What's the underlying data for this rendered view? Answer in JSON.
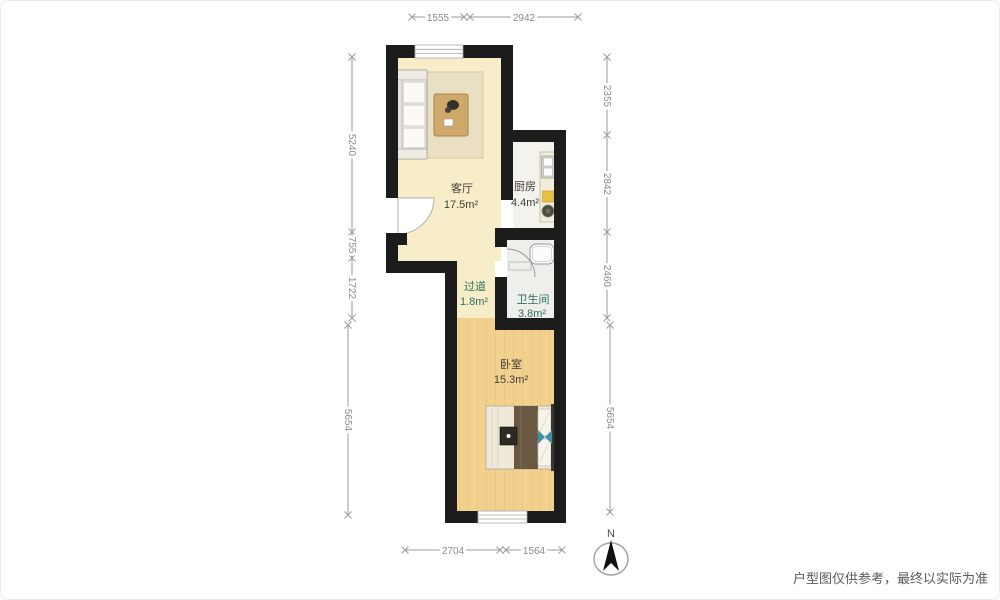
{
  "rooms": {
    "living": {
      "name": "客厅",
      "area": "17.5m²"
    },
    "kitchen": {
      "name": "厨房",
      "area": "4.4m²"
    },
    "hallway": {
      "name": "过道",
      "area": "1.8m²"
    },
    "bathroom": {
      "name": "卫生间",
      "area": "3.8m²"
    },
    "bedroom": {
      "name": "卧室",
      "area": "15.3m²"
    }
  },
  "dimensions": {
    "top": [
      "1555",
      "2942"
    ],
    "left": [
      "5240",
      "755",
      "1722",
      "5654"
    ],
    "right": [
      "2355",
      "2842",
      "2460",
      "5654"
    ],
    "bottom": [
      "2704",
      "1564"
    ]
  },
  "compass": {
    "label": "N"
  },
  "footer": {
    "disclaimer": "户型图仅供参考，最终以实际为准"
  },
  "colors": {
    "wall": "#1c1c1c",
    "living_floor": "#f8edc9",
    "bedroom_floor": "#f2d18e",
    "kitchen_floor": "#f4f2ec",
    "bathroom_floor": "#eeeeea",
    "dimension_gray": "#8b8b8b",
    "label_dark": "#3f3d36",
    "label_teal": "#2e6f5e"
  }
}
